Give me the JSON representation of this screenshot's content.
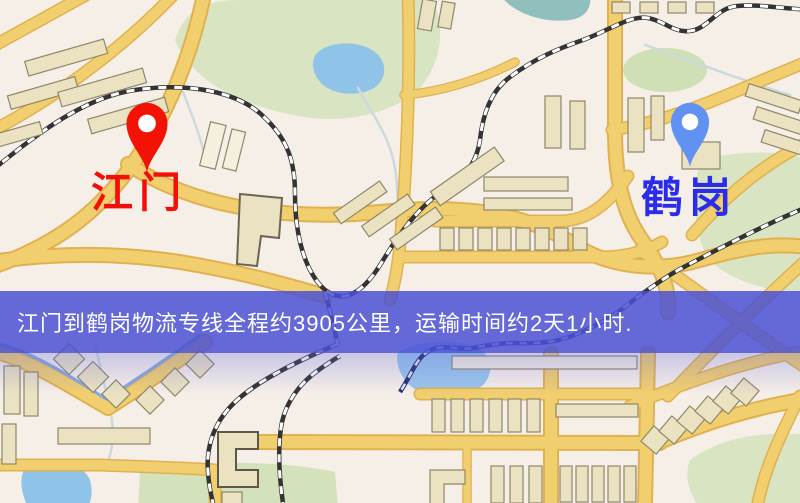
{
  "banner": {
    "text": "江门到鹤岗物流专线全程约3905公里，运输时间约2天1小时.",
    "bg_color": "#4b51d5",
    "text_color": "#ffffff"
  },
  "markers": {
    "origin": {
      "label": "江门",
      "pin_color": "#f21306",
      "label_color": "#f30e07"
    },
    "destination": {
      "label": "鹤岗",
      "pin_color": "#6191f1",
      "label_color": "#2b2bea"
    }
  },
  "map": {
    "colors": {
      "background": "#f6efe8",
      "road": "#f2cf6e",
      "road_casing": "#e0b150",
      "building": "#ebe2c2",
      "building_outline": "#8f8768",
      "park": "#d8e4c2",
      "water": "#8fc3e8",
      "railway": "#333333"
    }
  }
}
